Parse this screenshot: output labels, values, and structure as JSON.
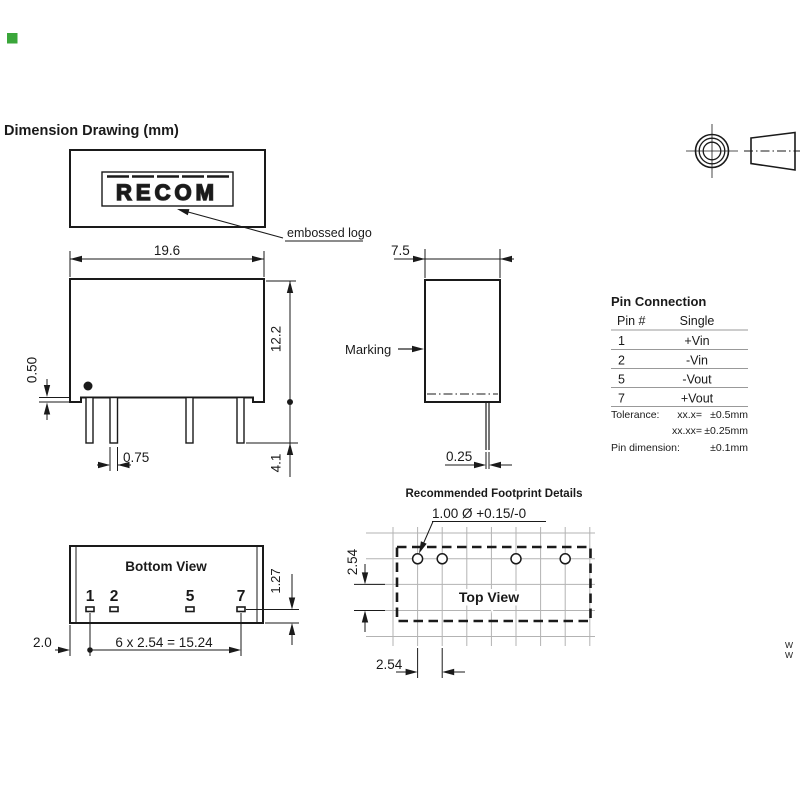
{
  "title": "Dimension Drawing (mm)",
  "accent": {
    "green_marker": "#3aa63a"
  },
  "logo_view": {
    "logo_text": "RECOM",
    "embossed_label": "embossed logo",
    "width_dim": "19.6"
  },
  "front_view": {
    "height_dim": "12.2",
    "standoff_dim": "0.50",
    "pin_width_dim": "0.75",
    "pin_length_dim": "4.1"
  },
  "side_view": {
    "width_dim": "7.5",
    "marking_label": "Marking",
    "pin_thickness_dim": "0.25"
  },
  "pin_connection": {
    "title": "Pin Connection",
    "columns": {
      "pin": "Pin #",
      "single": "Single"
    },
    "rows": [
      {
        "pin": "1",
        "single": "+Vin"
      },
      {
        "pin": "2",
        "single": "-Vin"
      },
      {
        "pin": "5",
        "single": "-Vout"
      },
      {
        "pin": "7",
        "single": "+Vout"
      }
    ],
    "tolerance": {
      "label": "Tolerance:",
      "x_key": "xx.x=",
      "x_val": "±0.5mm",
      "xx_key": "xx.xx=",
      "xx_val": "±0.25mm",
      "pin_label": "Pin dimension:",
      "pin_val": "±0.1mm"
    }
  },
  "bottom_view": {
    "title": "Bottom View",
    "pins": [
      "1",
      "2",
      "5",
      "7"
    ],
    "edge_dim": "2.0",
    "pitch_dim": "6 x 2.54 = 15.24",
    "pad_dim": "1.27"
  },
  "footprint": {
    "title": "Recommended Footprint Details",
    "hole_dim": "1.00 Ø +0.15/-0",
    "view_label": "Top View",
    "row_pitch_dim": "2.54",
    "col_pitch_dim": "2.54"
  },
  "watermark": {
    "line1": "W",
    "line2": "W"
  }
}
